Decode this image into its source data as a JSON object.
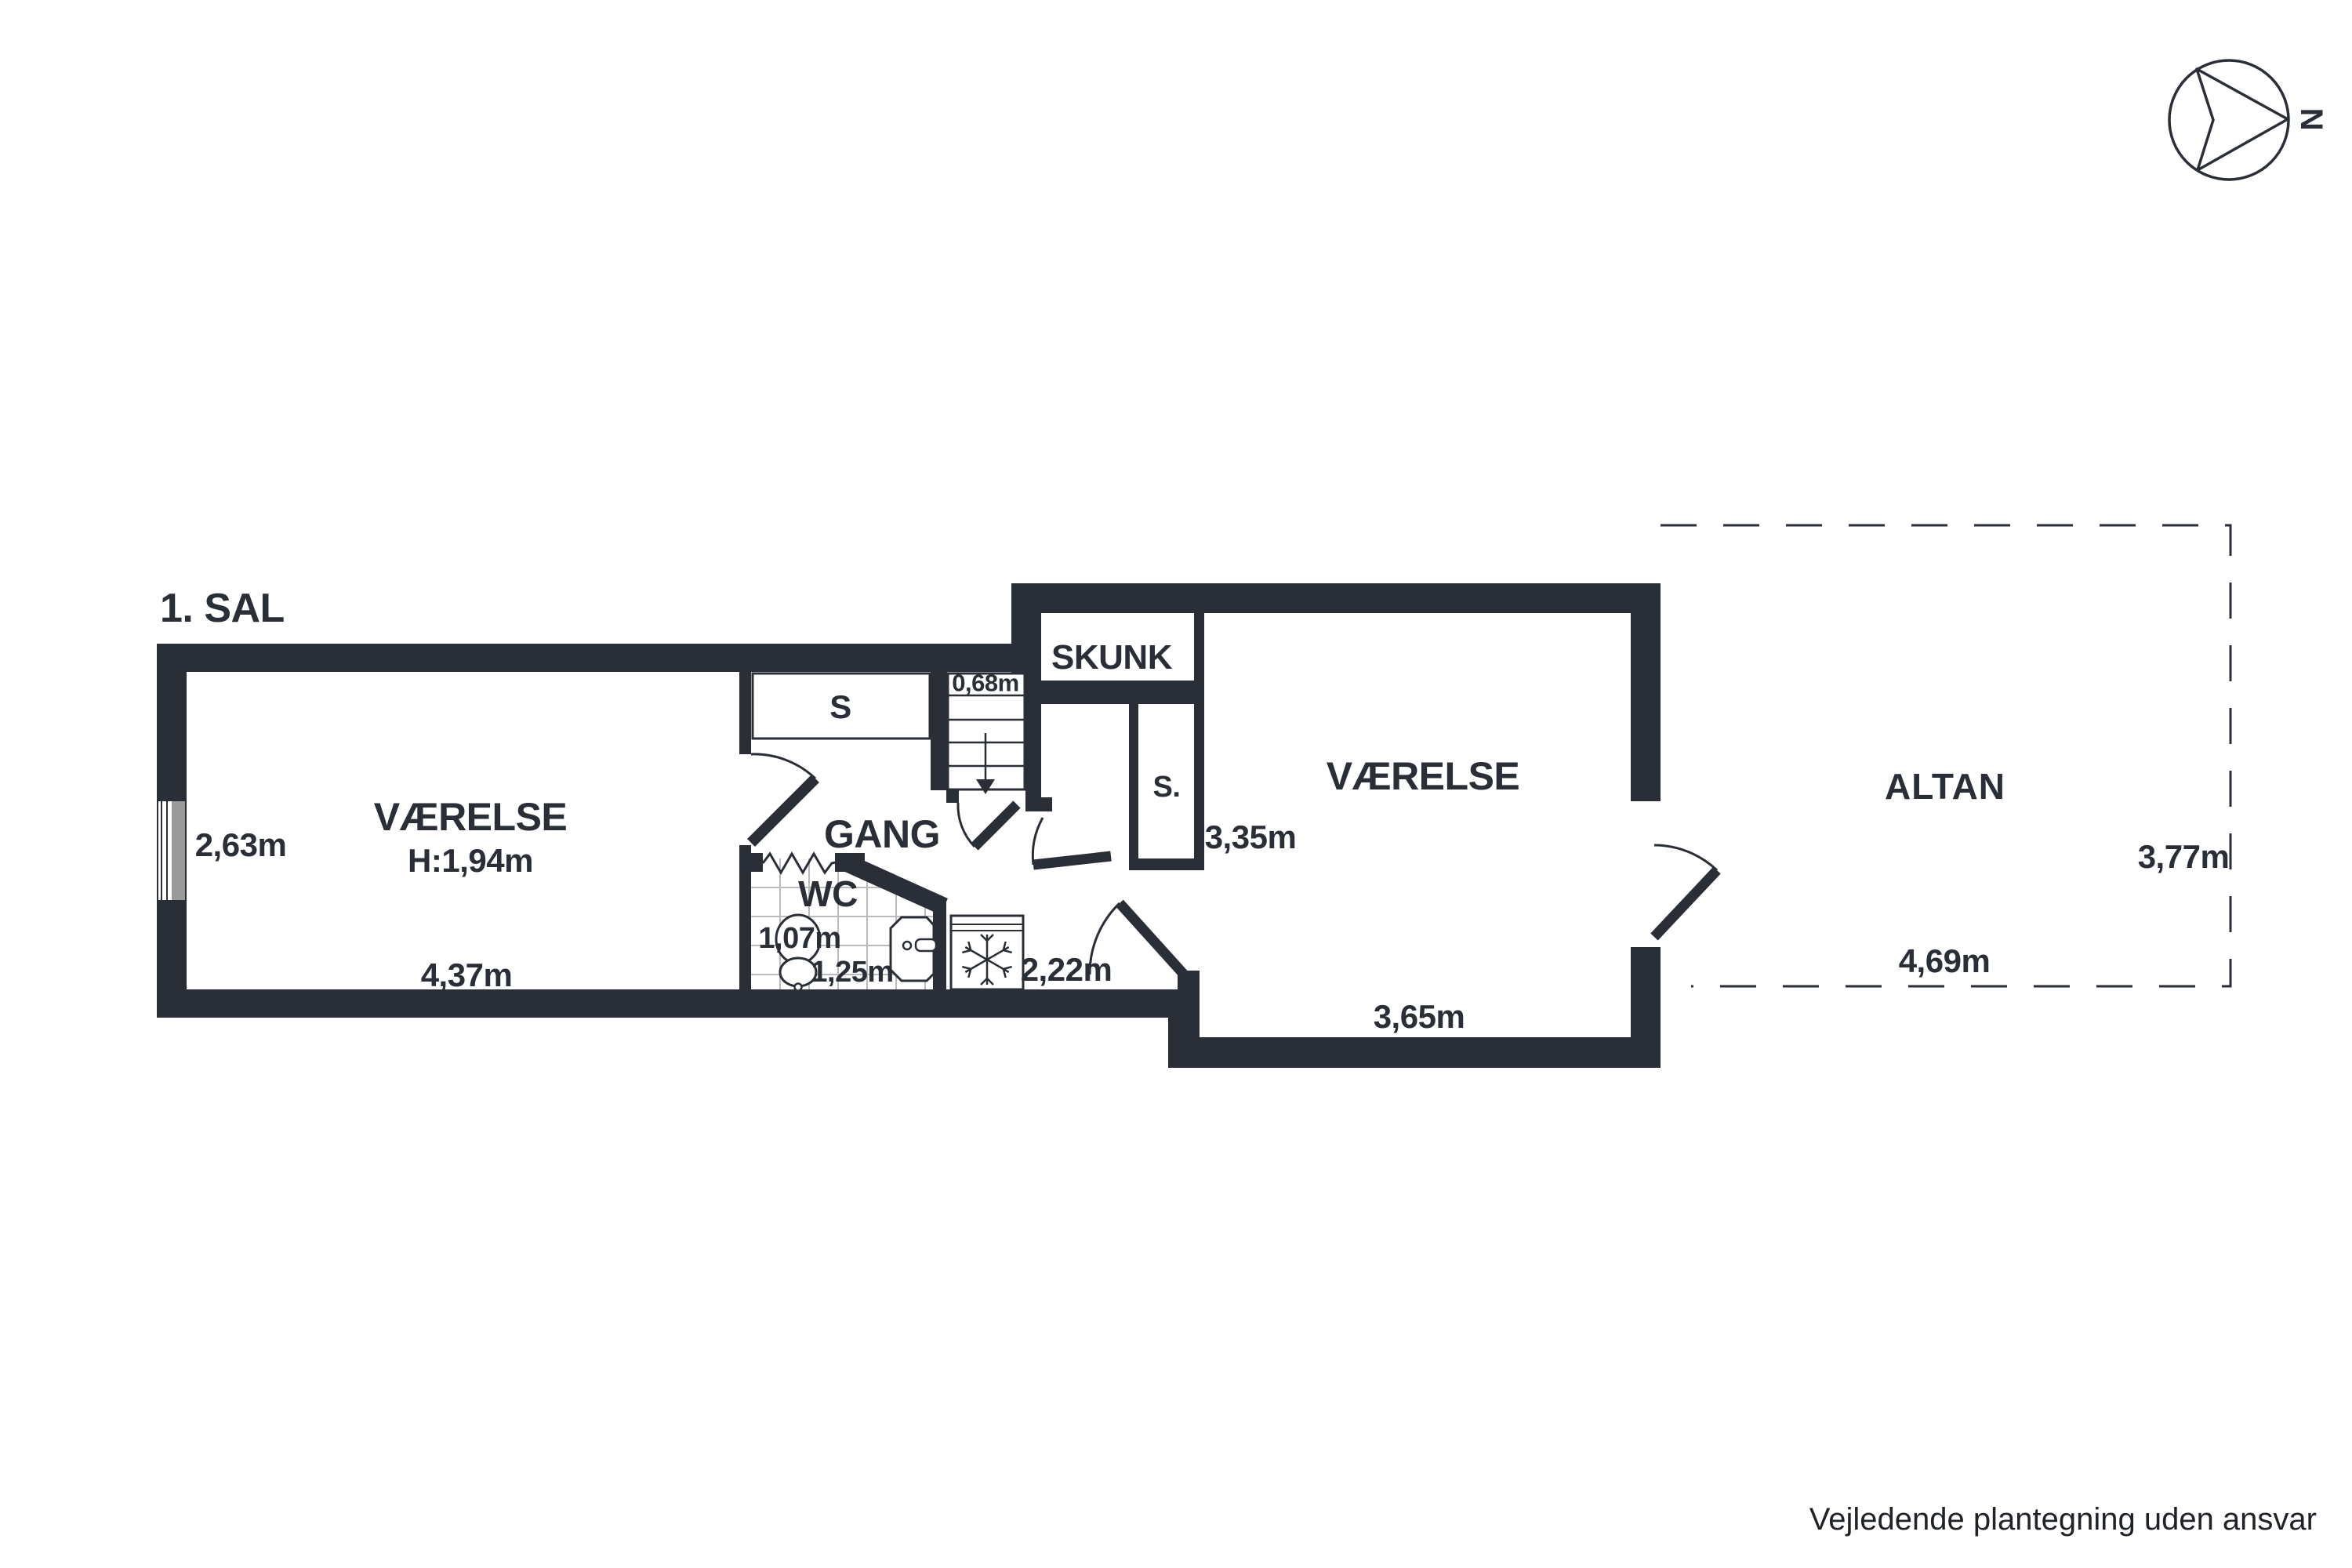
{
  "title": "1. SAL",
  "compass": {
    "north_label": "N"
  },
  "rooms": {
    "room_left": {
      "name": "VÆRELSE",
      "ceiling_height": "H:1,94m",
      "width": "2,63m",
      "length": "4,37m"
    },
    "closet_gang": {
      "label": "S"
    },
    "stairs": {
      "width": "0,68m"
    },
    "gang": {
      "name": "GANG"
    },
    "wc": {
      "name": "WC",
      "width": "1,07m",
      "length": "1,25m"
    },
    "nook": {
      "width": "2,22m"
    },
    "skunk": {
      "name": "SKUNK"
    },
    "closet_right": {
      "label": "S."
    },
    "room_right": {
      "name": "VÆRELSE",
      "width": "3,35m",
      "length": "3,65m"
    },
    "altan": {
      "name": "ALTAN",
      "depth": "3,77m",
      "width": "4,69m"
    }
  },
  "footer": {
    "disclaimer": "Vejledende plantegning uden ansvar"
  },
  "colors": {
    "wall": "#2a2e37",
    "window_pane": "#9b9b9b",
    "tile_line": "#bbbbbb",
    "background": "#ffffff"
  }
}
